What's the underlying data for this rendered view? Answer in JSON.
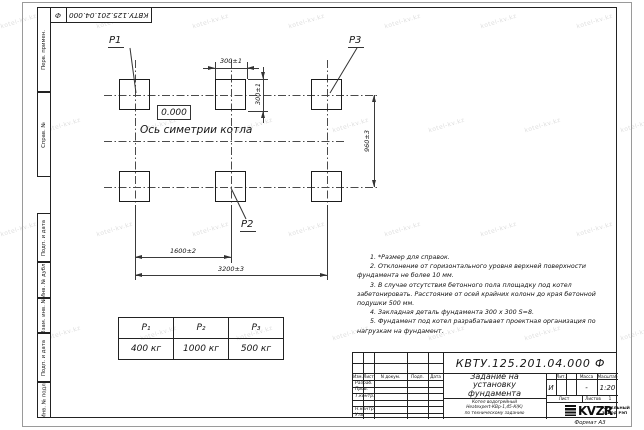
{
  "watermark": "kotel-kv.kz",
  "sheet": {
    "top_stamp": {
      "number": "КВТУ.125.201.04.000",
      "suffix": "Ф"
    },
    "margin_labels": [
      "Перв. примен.",
      "Справ. №",
      "Подп. и дата",
      "Инв. № дубл.",
      "Взам. инв. №",
      "Подп. и дата",
      "Инв. № подл."
    ],
    "format_label": "Формат А3"
  },
  "drawing": {
    "labels": {
      "p1": "P1",
      "p2": "P2",
      "p3": "P3"
    },
    "elevation": "0.000",
    "symmetry_axis": "Ось симетрии котла",
    "dims": {
      "top_width": "300±1",
      "side_height": "300±1",
      "rows": "960±3",
      "half": "1600±2",
      "full": "3200±3"
    }
  },
  "notes": [
    "1. *Размер для справок.",
    "2. Отклонение от горизонтального уровня верхней поверхности фундамента не более 10 мм.",
    "3. В случае отсутствия бетонного пола площадку под котел забетонировать. Расстояние от осей крайних колонн до края бетонной подушки 500 мм.",
    "4. Закладная деталь фундамента  300 х 300  S=8.",
    "5. Фундамент под котел разрабатывает проектная организация по нагрузкам на фундамент."
  ],
  "load_table": {
    "headers": [
      "P₁",
      "P₂",
      "P₃"
    ],
    "values": [
      "400 кг",
      "1000 кг",
      "500 кг"
    ]
  },
  "title_block": {
    "doc_number": "КВТУ.125.201.04.000 Ф",
    "title": "Задание на установку фундамента",
    "subtitle_lines": [
      "Котел водогрейный",
      "Heatexpert-КВр-1,45-К(К)",
      "по техническому заданию"
    ],
    "columns": [
      "Изм.",
      "Лист",
      "N докум.",
      "Подп.",
      "Дата"
    ],
    "rows": [
      "Разраб.",
      "Пров.",
      "Т.контр.",
      "Н.контр.",
      "Утв."
    ],
    "lit_header": "Лит.",
    "mass_header": "Масса",
    "scale_header": "Масштаб",
    "lit_value": "И",
    "mass_value": "-",
    "scale_value": "1:20",
    "sheet_label": "Лист",
    "sheets_label": "Листов",
    "sheets_value": "1",
    "logo_text": "KVZR",
    "company_line1": "КОТЕЛЬНЫЙ",
    "company_line2": "ЗАВОД РЭП"
  }
}
